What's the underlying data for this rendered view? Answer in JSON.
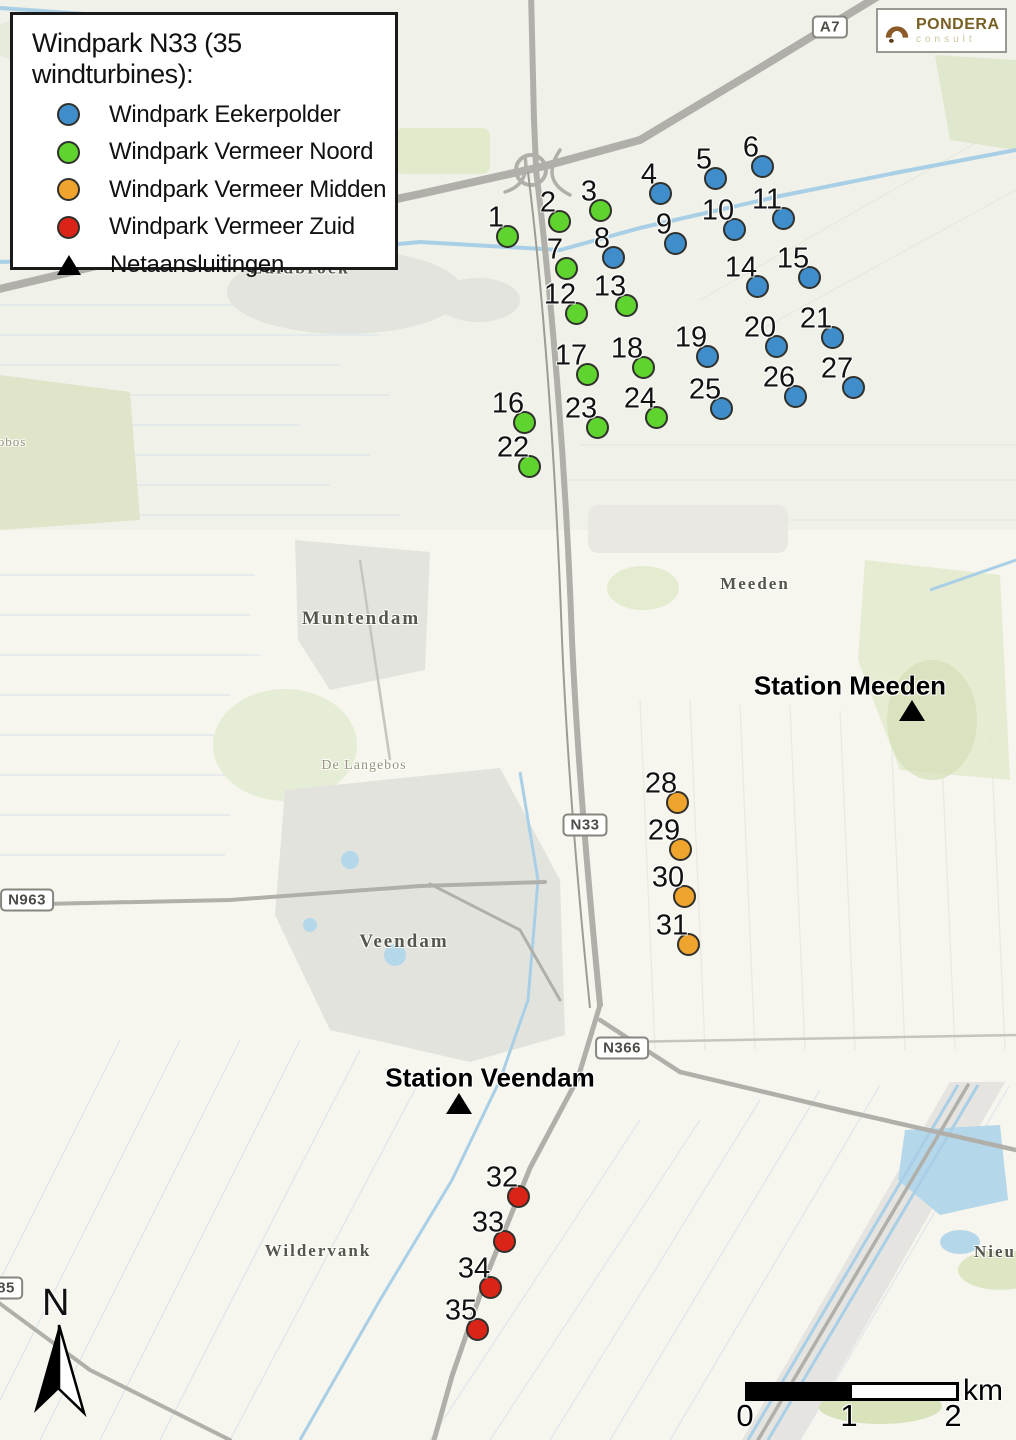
{
  "legend": {
    "title": "Windpark N33 (35 windturbines):",
    "items": [
      {
        "label": "Windpark Eekerpolder",
        "marker": "circle",
        "color": "#3f8ecb"
      },
      {
        "label": "Windpark Vermeer Noord",
        "marker": "circle",
        "color": "#5fd32e"
      },
      {
        "label": "Windpark Vermeer Midden",
        "marker": "circle",
        "color": "#efa42e"
      },
      {
        "label": "Windpark Vermeer Zuid",
        "marker": "circle",
        "color": "#da2418"
      },
      {
        "label": "Netaansluitingen",
        "marker": "triangle",
        "color": "#000000"
      }
    ]
  },
  "logo": {
    "name": "PONDERA",
    "sub": "consult"
  },
  "colors": {
    "eekerpolder": "#3f8ecb",
    "vermeer_noord": "#5fd32e",
    "vermeer_midden": "#efa42e",
    "vermeer_zuid": "#da2418"
  },
  "turbines": [
    {
      "id": 1,
      "x": 507,
      "y": 236,
      "group": "vermeer_noord"
    },
    {
      "id": 2,
      "x": 559,
      "y": 221,
      "group": "vermeer_noord"
    },
    {
      "id": 3,
      "x": 600,
      "y": 210,
      "group": "vermeer_noord"
    },
    {
      "id": 4,
      "x": 660,
      "y": 193,
      "group": "eekerpolder"
    },
    {
      "id": 5,
      "x": 715,
      "y": 178,
      "group": "eekerpolder"
    },
    {
      "id": 6,
      "x": 762,
      "y": 166,
      "group": "eekerpolder"
    },
    {
      "id": 7,
      "x": 566,
      "y": 268,
      "group": "vermeer_noord"
    },
    {
      "id": 8,
      "x": 613,
      "y": 257,
      "group": "eekerpolder"
    },
    {
      "id": 9,
      "x": 675,
      "y": 243,
      "group": "eekerpolder"
    },
    {
      "id": 10,
      "x": 734,
      "y": 229,
      "group": "eekerpolder"
    },
    {
      "id": 11,
      "x": 783,
      "y": 218,
      "group": "eekerpolder"
    },
    {
      "id": 12,
      "x": 576,
      "y": 313,
      "group": "vermeer_noord"
    },
    {
      "id": 13,
      "x": 626,
      "y": 305,
      "group": "vermeer_noord"
    },
    {
      "id": 14,
      "x": 757,
      "y": 286,
      "group": "eekerpolder"
    },
    {
      "id": 15,
      "x": 809,
      "y": 277,
      "group": "eekerpolder"
    },
    {
      "id": 16,
      "x": 524,
      "y": 422,
      "group": "vermeer_noord"
    },
    {
      "id": 17,
      "x": 587,
      "y": 374,
      "group": "vermeer_noord"
    },
    {
      "id": 18,
      "x": 643,
      "y": 367,
      "group": "vermeer_noord"
    },
    {
      "id": 19,
      "x": 707,
      "y": 356,
      "group": "eekerpolder"
    },
    {
      "id": 20,
      "x": 776,
      "y": 346,
      "group": "eekerpolder"
    },
    {
      "id": 21,
      "x": 832,
      "y": 337,
      "group": "eekerpolder"
    },
    {
      "id": 22,
      "x": 529,
      "y": 466,
      "group": "vermeer_noord"
    },
    {
      "id": 23,
      "x": 597,
      "y": 427,
      "group": "vermeer_noord"
    },
    {
      "id": 24,
      "x": 656,
      "y": 417,
      "group": "vermeer_noord"
    },
    {
      "id": 25,
      "x": 721,
      "y": 408,
      "group": "eekerpolder"
    },
    {
      "id": 26,
      "x": 795,
      "y": 396,
      "group": "eekerpolder"
    },
    {
      "id": 27,
      "x": 853,
      "y": 387,
      "group": "eekerpolder"
    },
    {
      "id": 28,
      "x": 677,
      "y": 802,
      "group": "vermeer_midden"
    },
    {
      "id": 29,
      "x": 680,
      "y": 849,
      "group": "vermeer_midden"
    },
    {
      "id": 30,
      "x": 684,
      "y": 896,
      "group": "vermeer_midden"
    },
    {
      "id": 31,
      "x": 688,
      "y": 944,
      "group": "vermeer_midden"
    },
    {
      "id": 32,
      "x": 518,
      "y": 1196,
      "group": "vermeer_zuid"
    },
    {
      "id": 33,
      "x": 504,
      "y": 1241,
      "group": "vermeer_zuid"
    },
    {
      "id": 34,
      "x": 490,
      "y": 1287,
      "group": "vermeer_zuid"
    },
    {
      "id": 35,
      "x": 477,
      "y": 1329,
      "group": "vermeer_zuid"
    }
  ],
  "stations": [
    {
      "label": "Station Meeden",
      "x": 850,
      "y": 686,
      "tx": 912,
      "ty": 700
    },
    {
      "label": "Station Veendam",
      "x": 490,
      "y": 1078,
      "tx": 459,
      "ty": 1093
    }
  ],
  "places": [
    {
      "label": "Zuidbroek",
      "x": 300,
      "y": 268,
      "size": 18,
      "muted": false
    },
    {
      "label": "Meeden",
      "x": 755,
      "y": 584,
      "size": 17,
      "muted": false
    },
    {
      "label": "Muntendam",
      "x": 361,
      "y": 619,
      "size": 19,
      "muted": false
    },
    {
      "label": "De Langebos",
      "x": 364,
      "y": 766,
      "size": 14,
      "muted": true
    },
    {
      "label": "Veendam",
      "x": 404,
      "y": 942,
      "size": 19,
      "muted": false
    },
    {
      "label": "Wildervank",
      "x": 318,
      "y": 1251,
      "size": 17,
      "muted": false
    },
    {
      "label": "Nieu",
      "x": 995,
      "y": 1252,
      "size": 17,
      "muted": false
    },
    {
      "label": "obos",
      "x": 12,
      "y": 442,
      "size": 13,
      "muted": true
    }
  ],
  "road_shields": [
    {
      "label": "A7",
      "x": 830,
      "y": 27
    },
    {
      "label": "N33",
      "x": 585,
      "y": 825
    },
    {
      "label": "N963",
      "x": 27,
      "y": 900
    },
    {
      "label": "N366",
      "x": 622,
      "y": 1048
    },
    {
      "label": "85",
      "x": 6,
      "y": 1288
    }
  ],
  "scale_bar": {
    "ticks": [
      "0",
      "1",
      "2"
    ],
    "unit": "km"
  },
  "north": {
    "label": "N"
  }
}
